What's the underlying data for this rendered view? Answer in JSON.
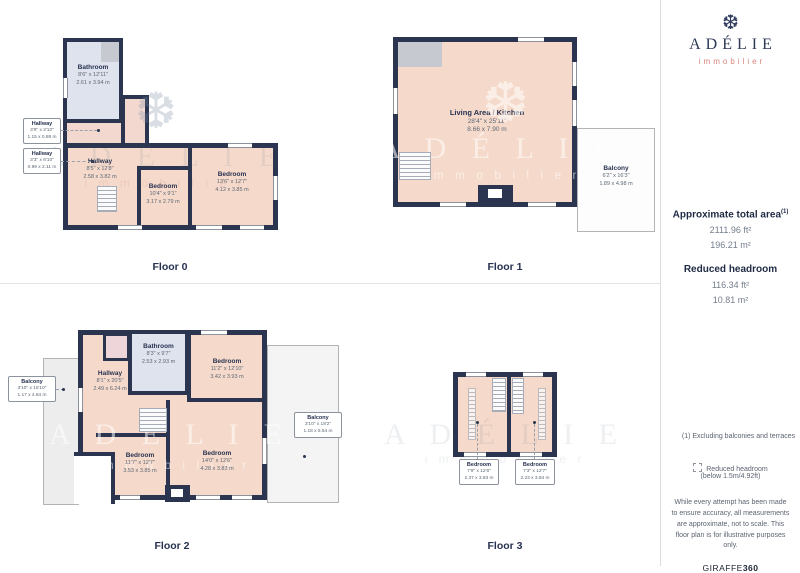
{
  "sidebar": {
    "brand": "ADÉLIE",
    "brand_sub": "immobilier",
    "snowflake": "❆",
    "total_area_title": "Approximate total area",
    "total_area_sup": "(1)",
    "total_area_ft": "2111.96 ft²",
    "total_area_m": "196.21 m²",
    "headroom_title": "Reduced headroom",
    "headroom_ft": "116.34 ft²",
    "headroom_m": "10.81 m²",
    "footnote": "(1) Excluding balconies and terraces",
    "legend_title": "Reduced headroom",
    "legend_sub": "(below 1.5m/4.92ft)",
    "disclaimer": "While every attempt has been made to ensure accuracy, all measurements are approximate, not to scale. This floor plan is for illustrative purposes only.",
    "brand_footer_name": "GIRAFFE",
    "brand_footer_num": "360"
  },
  "watermark": {
    "brand": "A D É L I E",
    "sub": "i m m o b i l i e r",
    "snowflake": "❆"
  },
  "colors": {
    "wall": "#2b3550",
    "room_fill": "#f5dacb",
    "bathroom_fill": "#dfe3ee",
    "vestibule_fill": "#f3d8cf",
    "terrace_fill": "#ededed",
    "accent": "#d4837a"
  },
  "floors": [
    {
      "label": "Floor 0",
      "rooms": [
        {
          "name": "Bathroom",
          "ft": "8'6\" x 12'11\"",
          "m": "2.61 x 3.94 m"
        },
        {
          "name": "Hallway",
          "ft": "3'9\" x 2'10\"",
          "m": "1.15 x 0.88 m"
        },
        {
          "name": "Hallway",
          "ft": "3'3\" x 6'10\"",
          "m": "0.99 x 2.11 m"
        },
        {
          "name": "Hallway",
          "ft": "8'5\" x 12'8\"",
          "m": "2.58 x 3.82 m"
        },
        {
          "name": "Bedroom",
          "ft": "10'4\" x 9'1\"",
          "m": "3.17 x 2.79 m"
        },
        {
          "name": "Bedroom",
          "ft": "13'6\" x 12'7\"",
          "m": "4.12 x 3.85 m"
        }
      ]
    },
    {
      "label": "Floor 1",
      "rooms": [
        {
          "name": "Living Area / Kitchen",
          "ft": "28'4\" x 25'11\"",
          "m": "8.66 x 7.90 m"
        },
        {
          "name": "Balcony",
          "ft": "6'2\" x 16'3\"",
          "m": "1.89 x 4.98 m"
        }
      ]
    },
    {
      "label": "Floor 2",
      "rooms": [
        {
          "name": "Balcony",
          "ft": "3'10\" x 15'10\"",
          "m": "1.17 x 4.84 m"
        },
        {
          "name": "Hallway",
          "ft": "8'1\" x 20'5\"",
          "m": "2.49 x 6.24 m"
        },
        {
          "name": "Bathroom",
          "ft": "8'3\" x 9'7\"",
          "m": "2.53 x 2.93 m"
        },
        {
          "name": "Bedroom",
          "ft": "11'2\" x 12'10\"",
          "m": "3.42 x 3.93 m"
        },
        {
          "name": "Bedroom",
          "ft": "11'7\" x 12'7\"",
          "m": "3.53 x 3.85 m"
        },
        {
          "name": "Bedroom",
          "ft": "14'0\" x 12'6\"",
          "m": "4.28 x 3.83 m"
        },
        {
          "name": "Balcony",
          "ft": "3'10\" x 18'2\"",
          "m": "1.18 x 5.54 m"
        }
      ]
    },
    {
      "label": "Floor 3",
      "rooms": [
        {
          "name": "Bedroom",
          "ft": "7'9\" x 12'6\"",
          "m": "2.37 x 3.83 m"
        },
        {
          "name": "Bedroom",
          "ft": "7'3\" x 12'7\"",
          "m": "2.23 x 3.84 m"
        }
      ]
    }
  ]
}
